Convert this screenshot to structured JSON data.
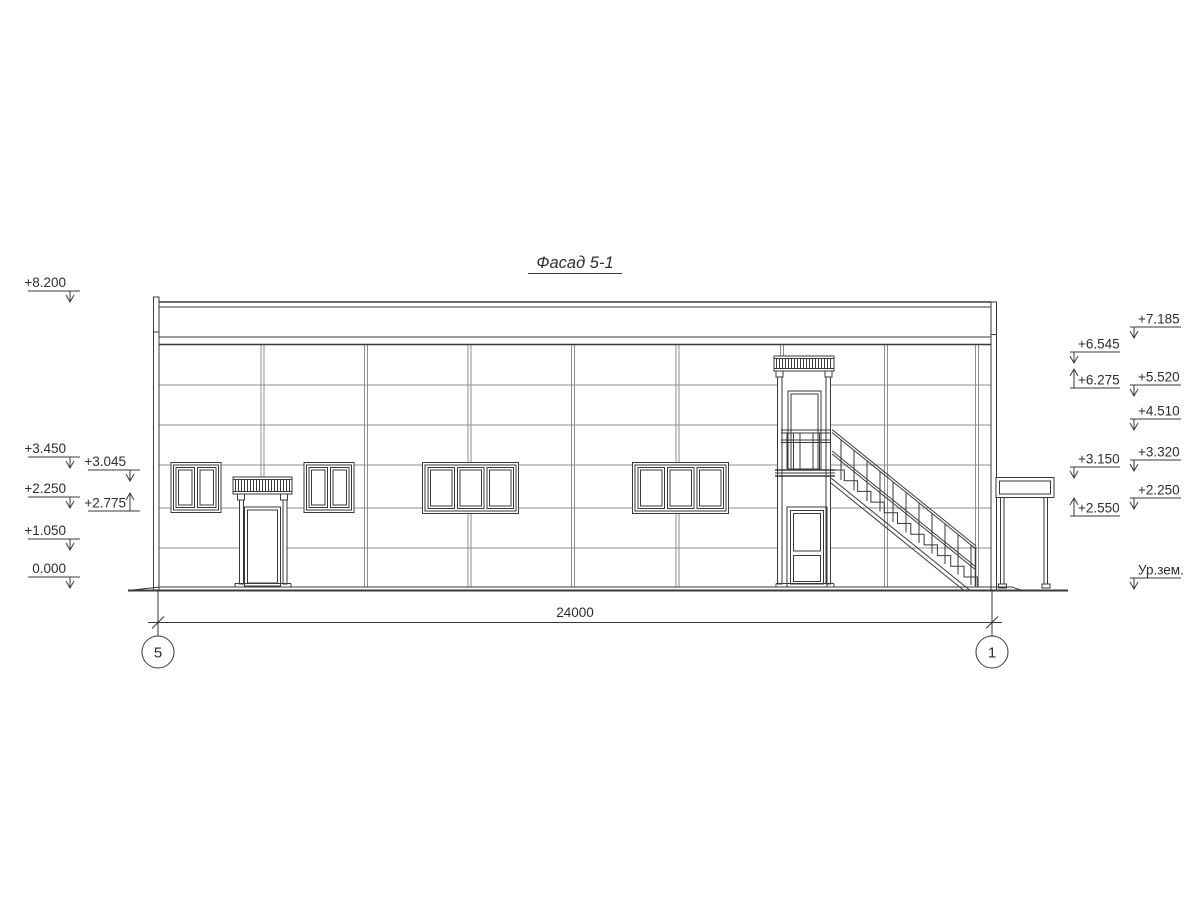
{
  "drawing": {
    "title": "Фасад 5-1",
    "bottom": {
      "dimension_total": "24000",
      "axis_left": "5",
      "axis_right": "1"
    },
    "elevations": {
      "left_outer": [
        {
          "label": "+8.200"
        },
        {
          "label": "+3.450"
        },
        {
          "label": "+2.250"
        },
        {
          "label": "+1.050"
        },
        {
          "label": "0.000"
        }
      ],
      "left_inner": [
        {
          "label": "+3.045"
        },
        {
          "label": "+2.775"
        }
      ],
      "right_inner": [
        {
          "label": "+6.545"
        },
        {
          "label": "+6.275"
        },
        {
          "label": "+3.150"
        },
        {
          "label": "+2.550"
        }
      ],
      "right_outer": [
        {
          "label": "+7.185"
        },
        {
          "label": "+5.520"
        },
        {
          "label": "+4.510"
        },
        {
          "label": "+3.320"
        },
        {
          "label": "+2.250"
        },
        {
          "label": "Ур.зем."
        }
      ]
    },
    "colors": {
      "line": "#3a3a3a",
      "panel": "#8f8f8f",
      "bg": "#ffffff"
    }
  }
}
